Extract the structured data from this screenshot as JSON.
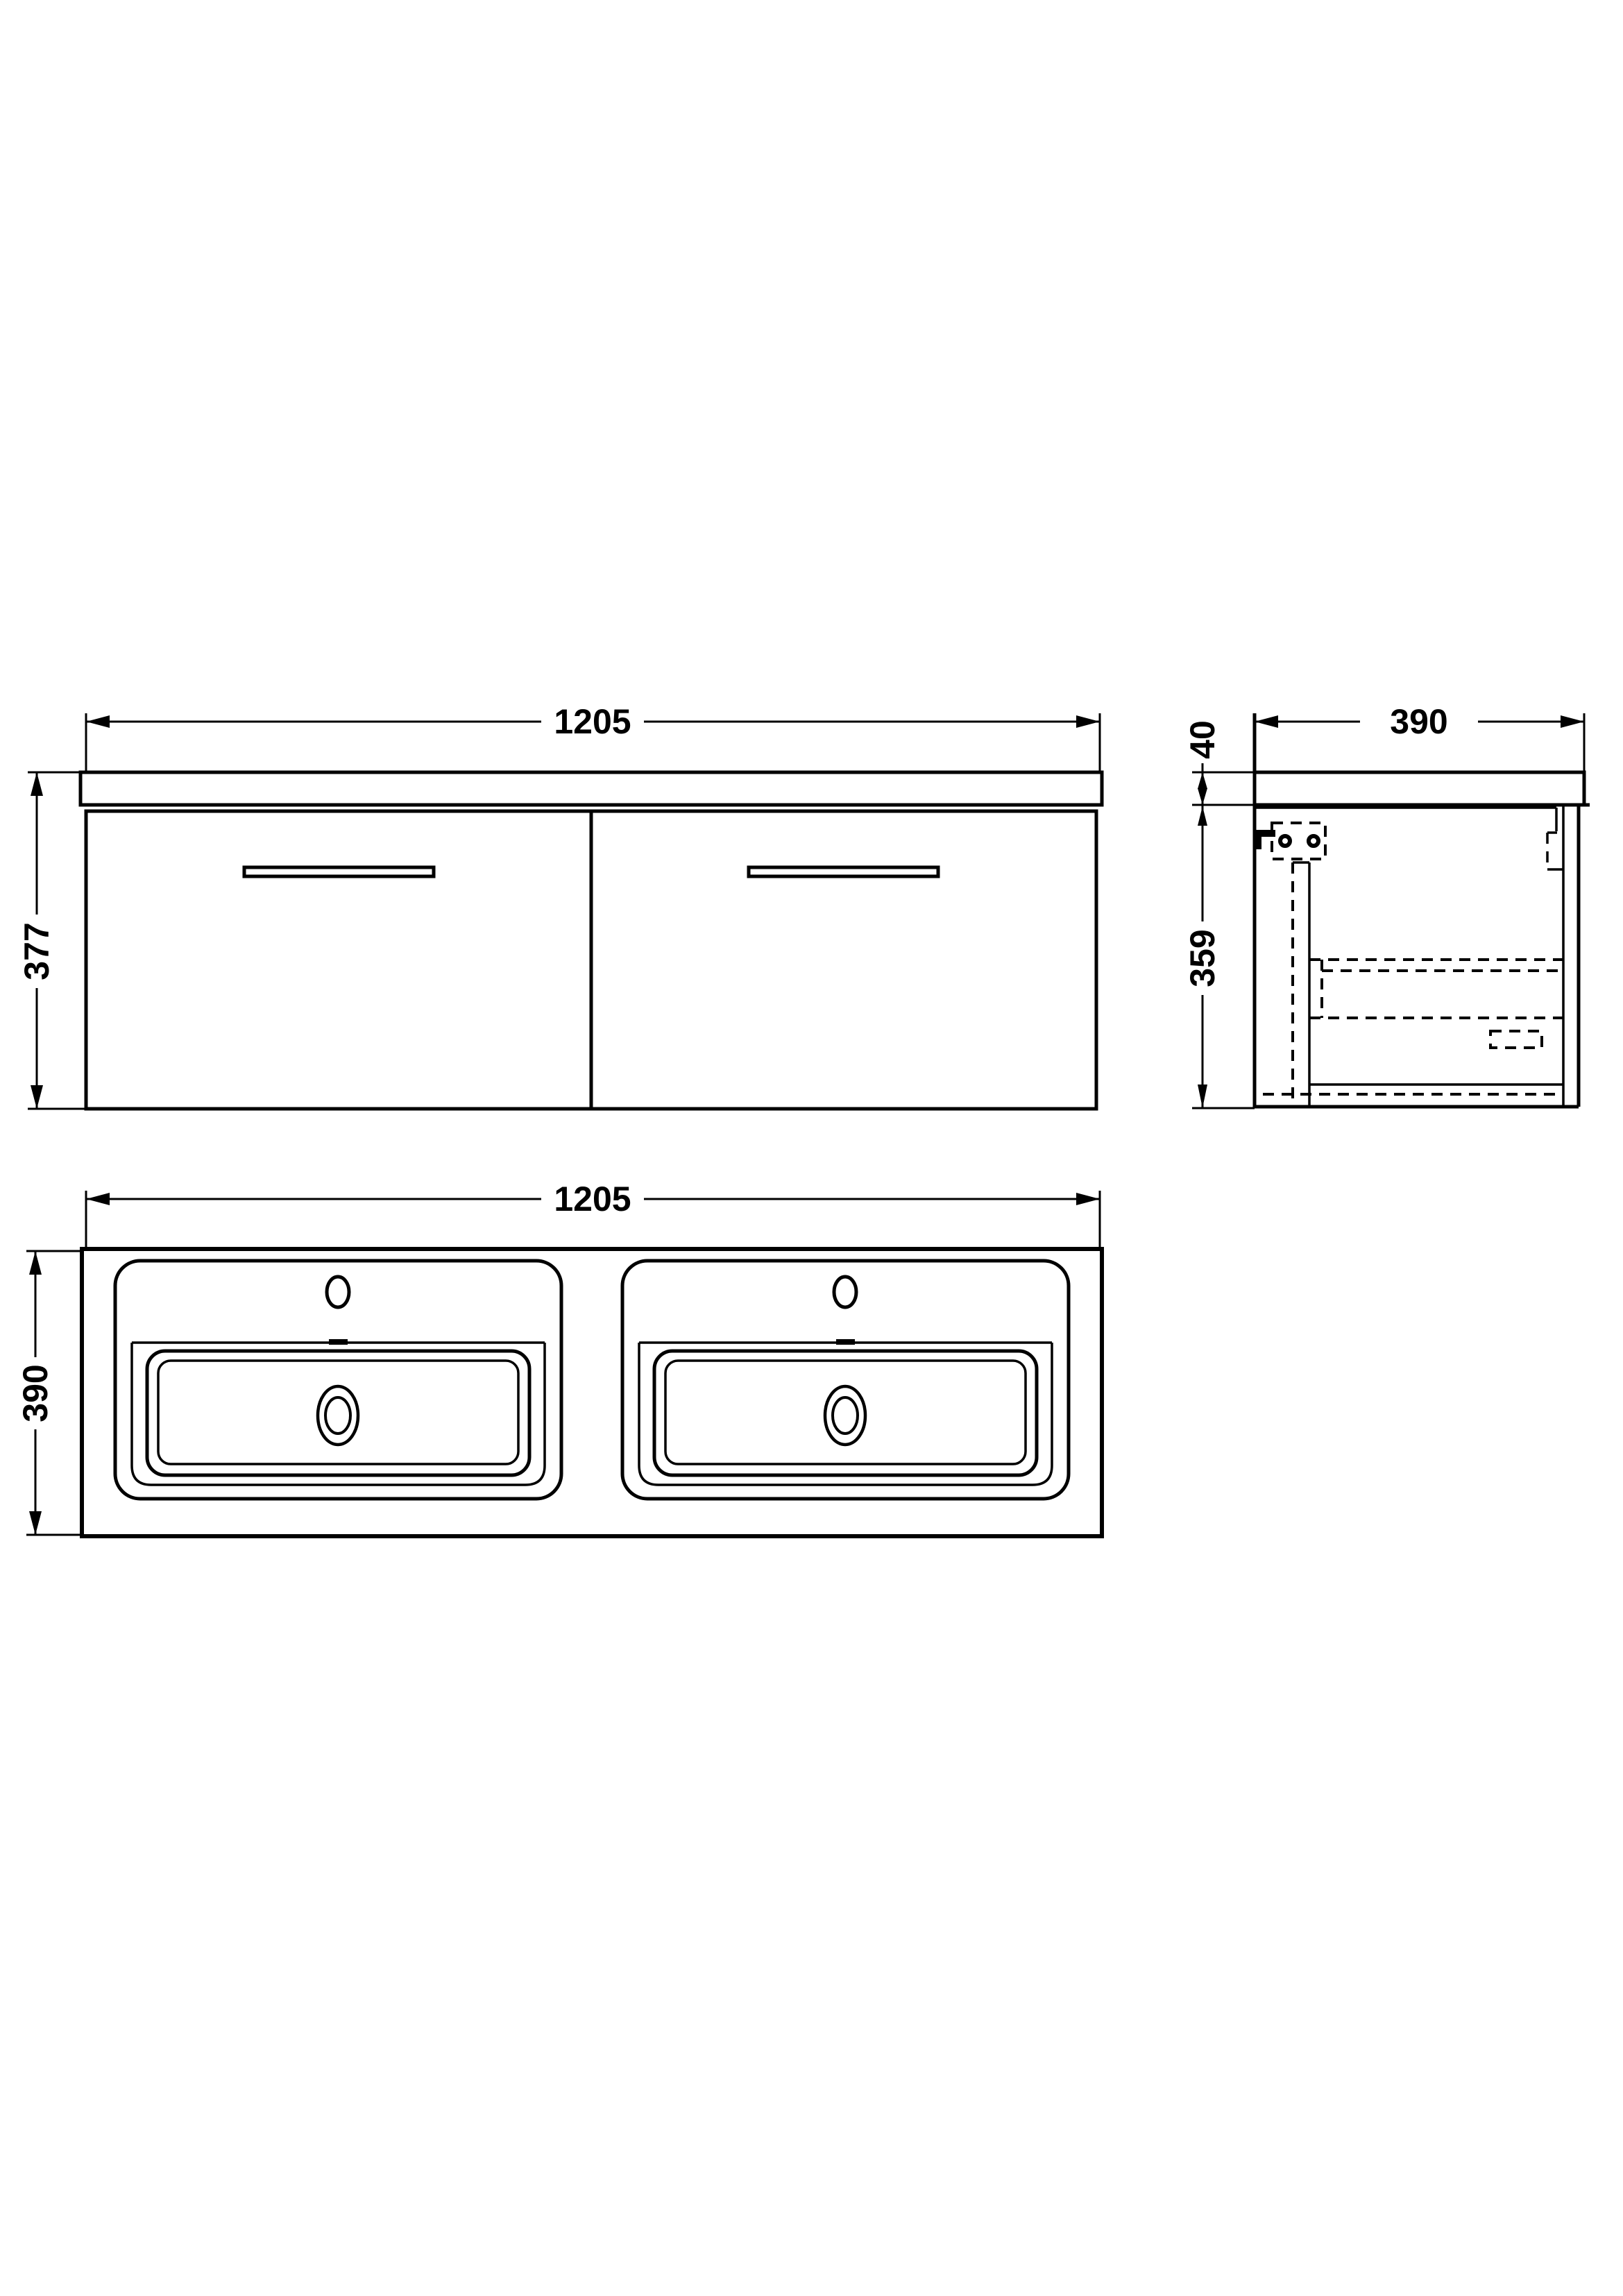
{
  "drawing": {
    "title": "wall-hung vanity unit with two drawers and double basin - dimensioned technical drawing",
    "background_color": "#ffffff",
    "line_color": "#000000",
    "views": {
      "front_elevation": {
        "name": "front elevation",
        "width_mm": "1205",
        "height_mm": "377"
      },
      "side_section": {
        "name": "side section",
        "depth_mm": "390",
        "worktop_thickness_mm": "40",
        "cabinet_height_mm": "359"
      },
      "plan_basin": {
        "name": "basin plan view",
        "width_mm": "1205",
        "depth_mm": "390"
      }
    }
  }
}
